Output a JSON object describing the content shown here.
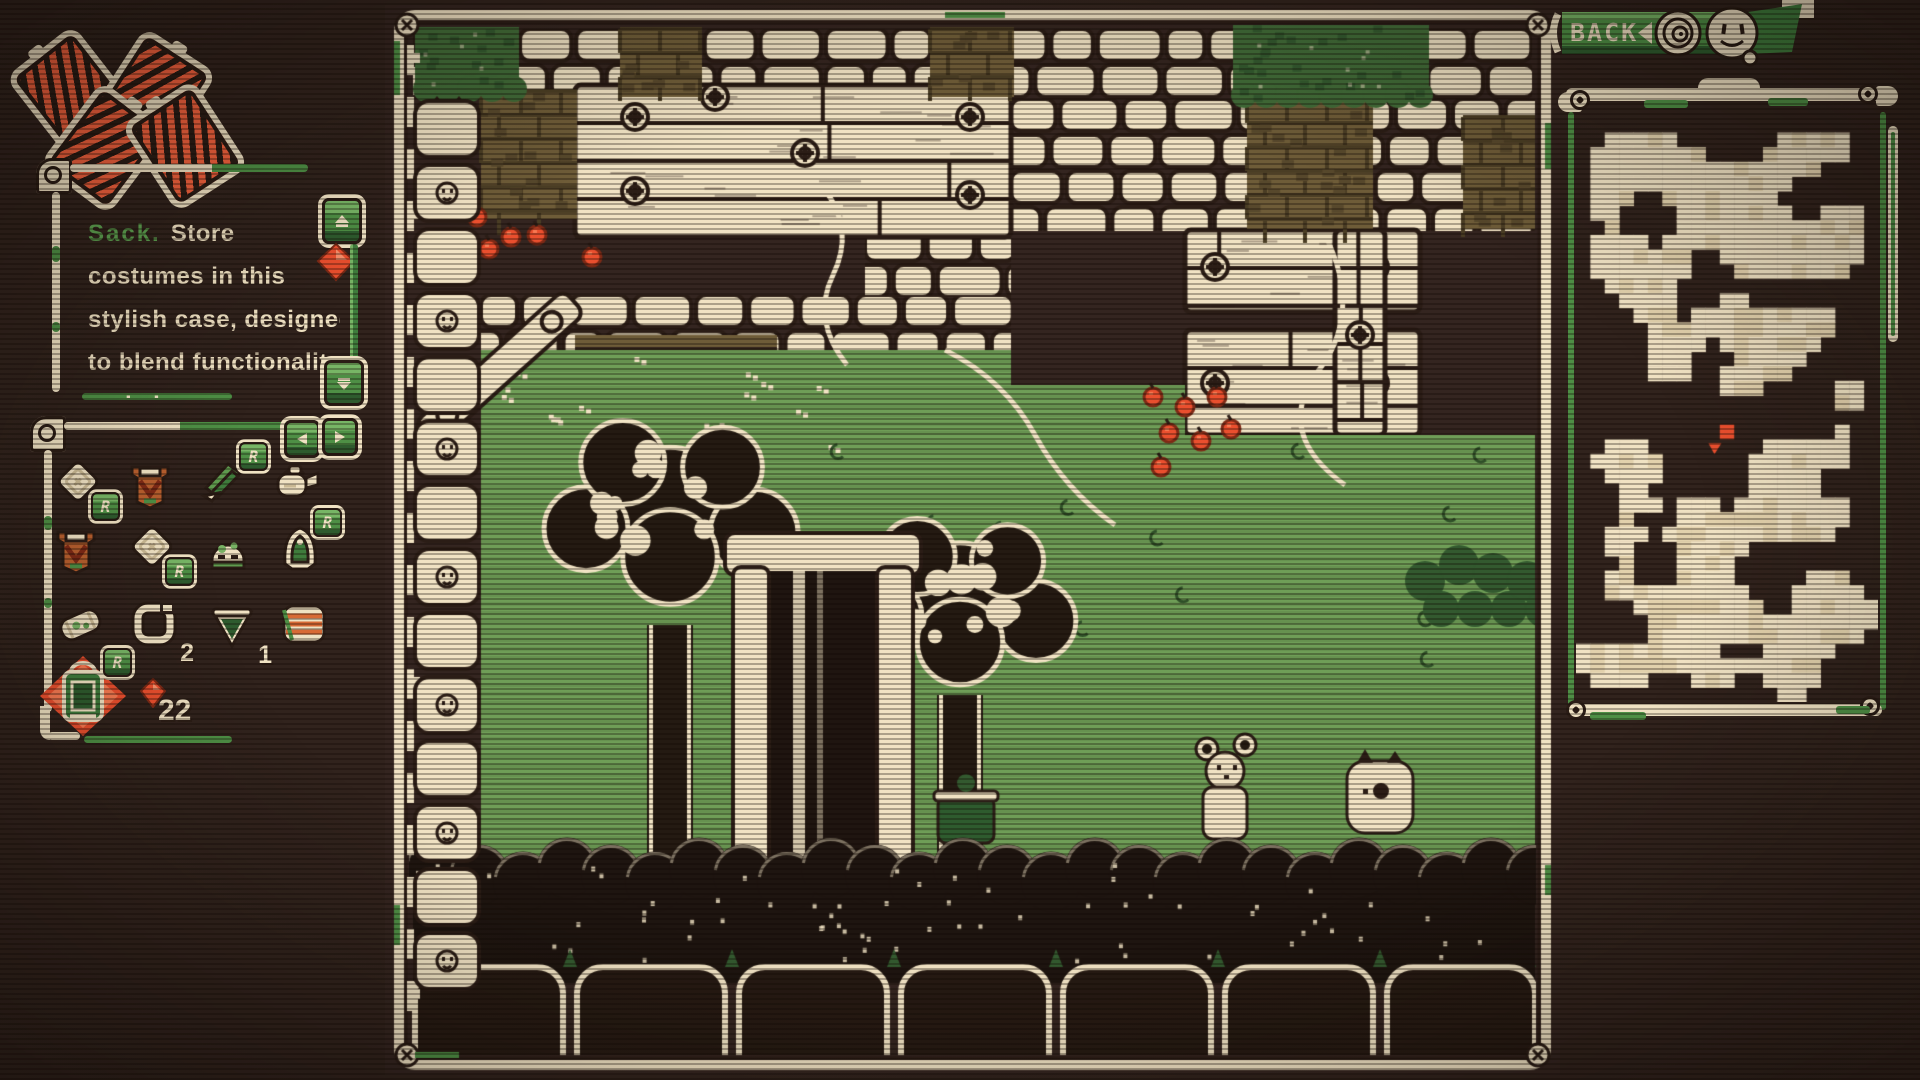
{
  "palette": {
    "background": "#31231d",
    "cream": "#f0e2c3",
    "cream_dark": "#c9b893",
    "dark": "#2b1d16",
    "ui_green": "#4e8f45",
    "ui_green_light": "#77b565",
    "ui_green_dark": "#2e5b2e",
    "field_green": "#6f9e57",
    "leaf_green": "#416b38",
    "olive": "#6e5c38",
    "red": "#ea4f2e",
    "red_light": "#f77a52"
  },
  "hud_sacks": {
    "icon": "sack-icon",
    "count": 4
  },
  "tooltip": {
    "title": "Sack.",
    "line1": "Store",
    "lines": [
      "costumes in this",
      "stylish case, designed",
      "to blend functionality",
      "and elegance"
    ],
    "scroll_up_icon": "scroll-up-arrow-icon",
    "scroll_down_icon": "scroll-down-arrow-icon",
    "gem_icon": "red-gem-icon"
  },
  "inventory": {
    "prev_icon": "left-arrow-icon",
    "next_icon": "right-arrow-icon",
    "items": [
      {
        "icon": "sack-icon",
        "badge": "R"
      },
      {
        "icon": "vest-icon"
      },
      {
        "icon": "fin-icon",
        "badge": "R"
      },
      {
        "icon": "kettle-icon"
      },
      {
        "icon": "vest-icon"
      },
      {
        "icon": "sack-icon",
        "badge": "R"
      },
      {
        "icon": "helmet-icon"
      },
      {
        "icon": "cloak-icon",
        "badge": "R"
      },
      {
        "icon": "roll-icon"
      },
      {
        "icon": "ring-icon",
        "count": "2"
      },
      {
        "icon": "cone-icon",
        "count": "1"
      },
      {
        "icon": "striped-vest-icon"
      },
      {
        "icon": "lantern-icon",
        "badge": "R",
        "selected": true
      }
    ],
    "currency": {
      "icon": "red-gem-icon",
      "count": "22"
    }
  },
  "back_button": {
    "label": "BACK",
    "icons": [
      "back-chevron-icon",
      "spiral-icon",
      "smiley-face-icon"
    ]
  },
  "minimap": {
    "marker_icon": "player-marker-icon",
    "marker_color": "#ea4f2e"
  }
}
